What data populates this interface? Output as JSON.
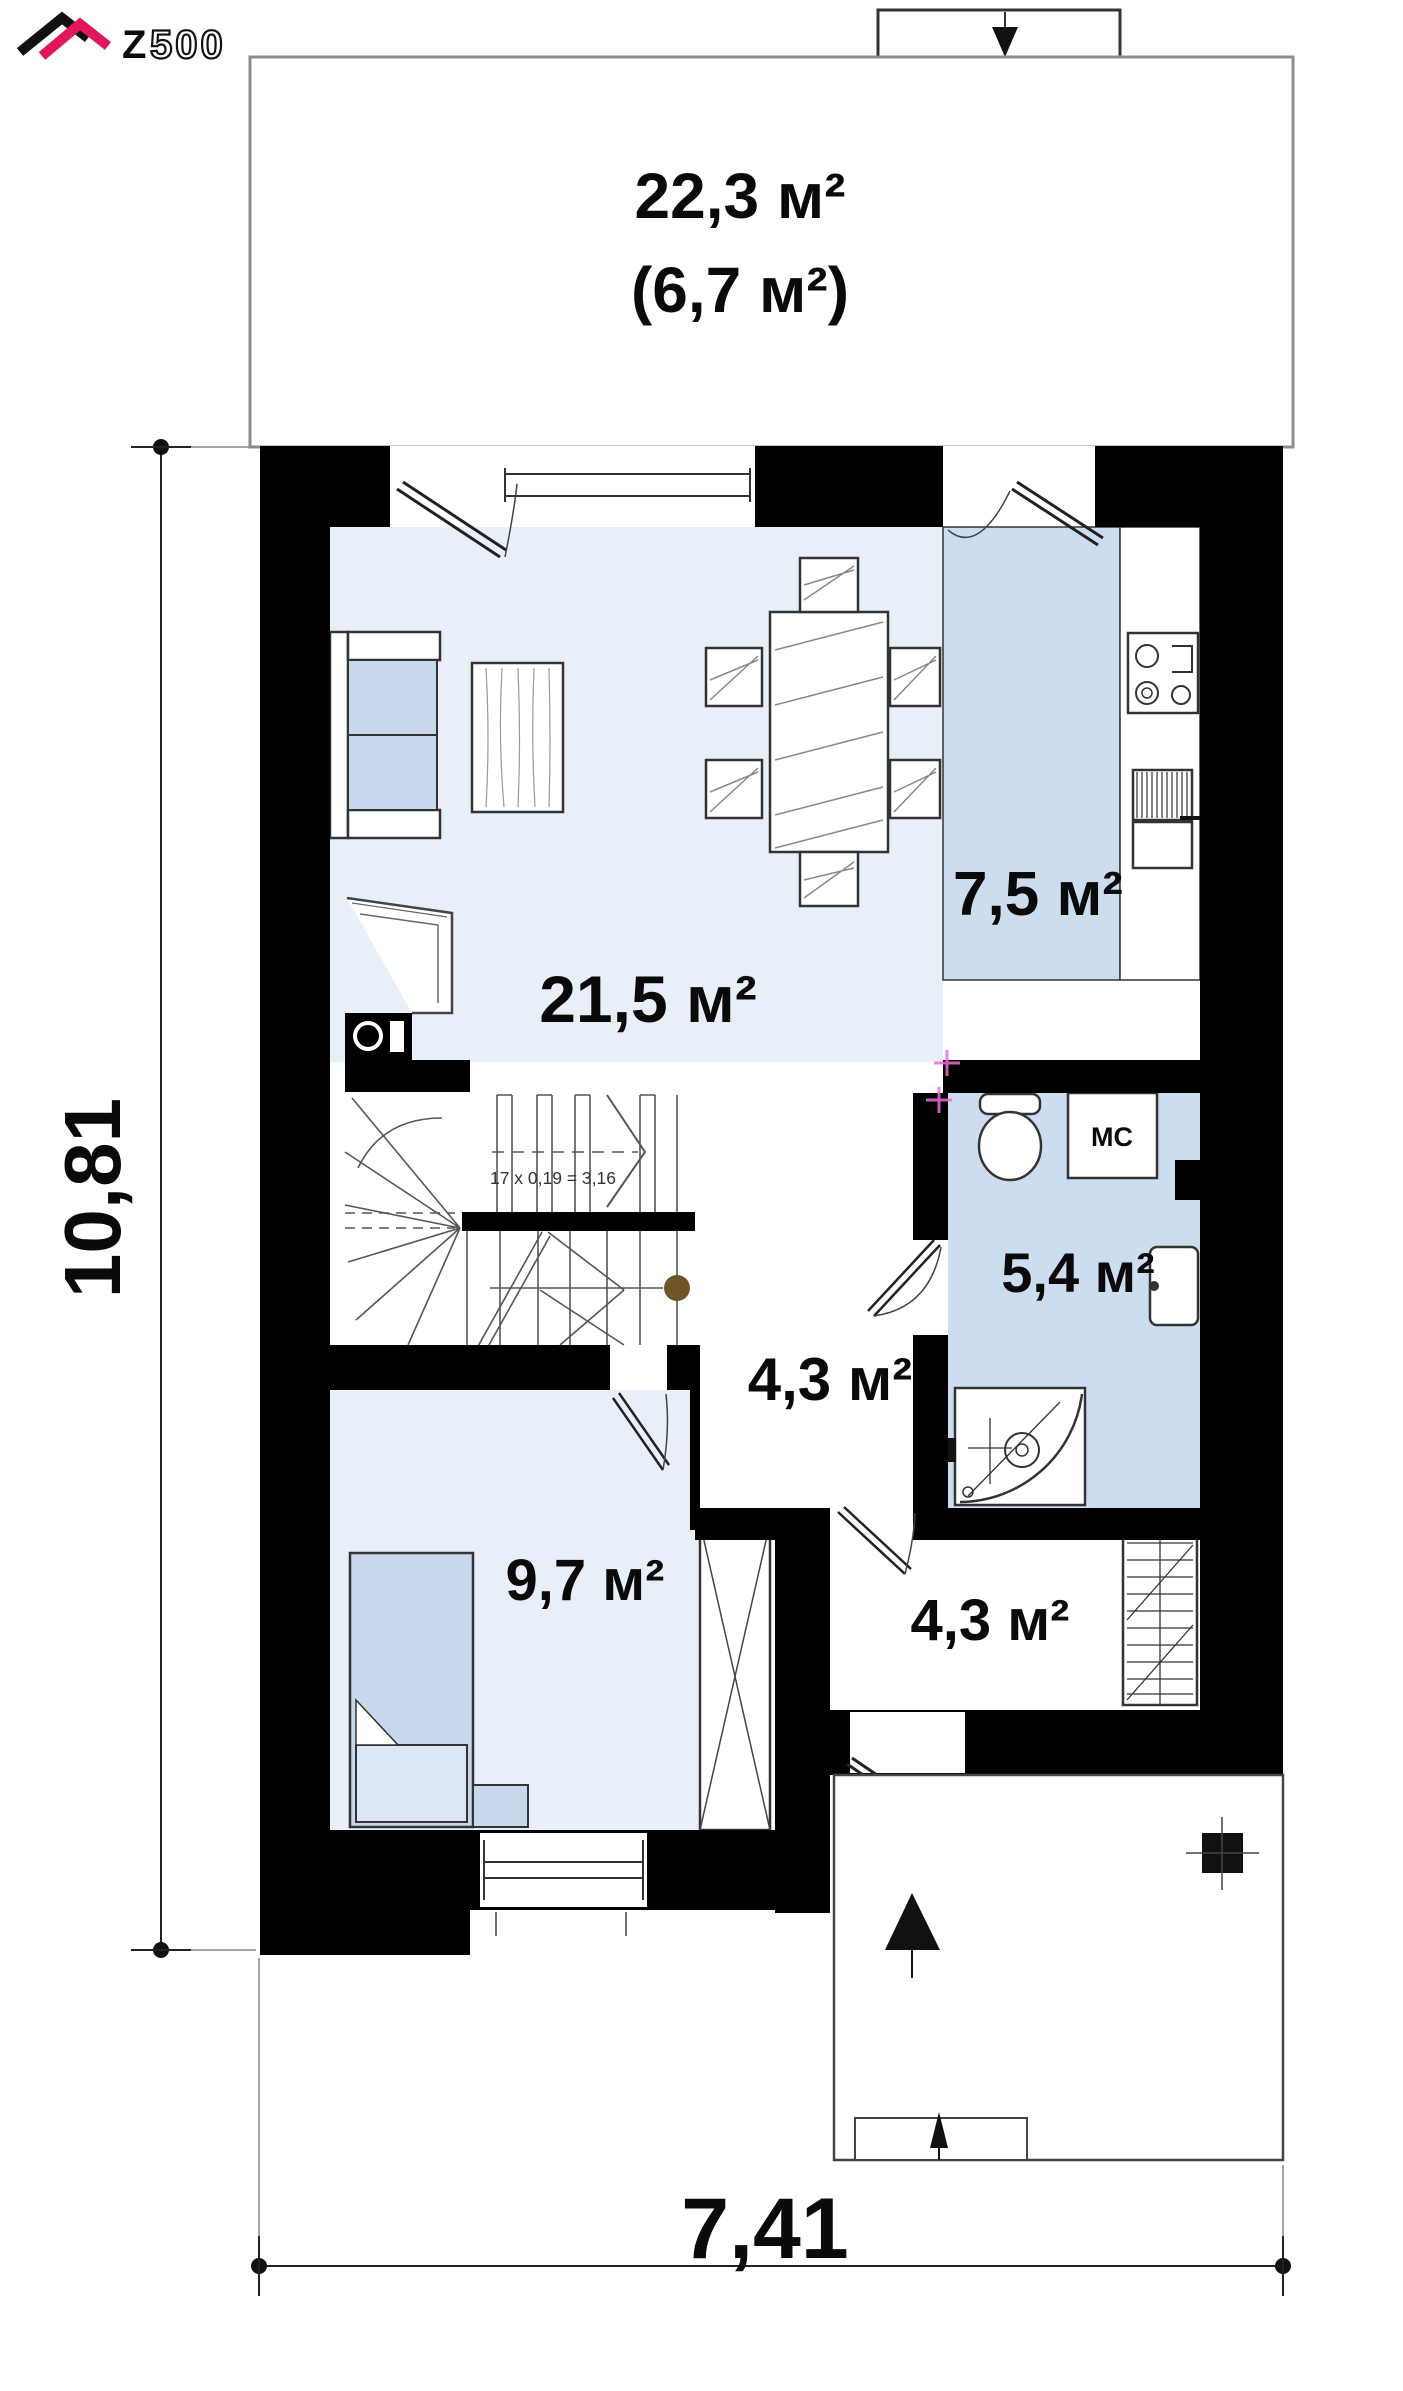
{
  "logo": {
    "brand_z": "Z",
    "brand_rest": "500",
    "full": "Z500"
  },
  "attic": {
    "area": "22,3 м²",
    "area_secondary": "(6,7 м²)"
  },
  "rooms": {
    "living": {
      "name": "living-room",
      "area": "21,5 м²"
    },
    "kitchen": {
      "name": "kitchen",
      "area": "7,5 м²"
    },
    "bathroom": {
      "name": "bathroom",
      "area": "5,4 м²"
    },
    "hall": {
      "name": "hall",
      "area": "4,3 м²"
    },
    "bedroom": {
      "name": "bedroom",
      "area": "9,7 м²"
    },
    "vestibule": {
      "name": "vestibule",
      "area": "4,3 м²"
    }
  },
  "labels": {
    "washing_machine": "МС",
    "stair_formula": "17 x 0,19 = 3,16"
  },
  "dimensions": {
    "overall_width_m": "7,41",
    "overall_depth_m": "10,81"
  },
  "colors": {
    "wall": "#000000",
    "floor_light": "#e9eff8",
    "floor_blue": "#cdddf0",
    "furniture_blue": "#c7d7ec",
    "logo_pink": "#e0175b",
    "newel_brown": "#6f5329",
    "plumbing_mark_pink": "#f06ad8"
  }
}
